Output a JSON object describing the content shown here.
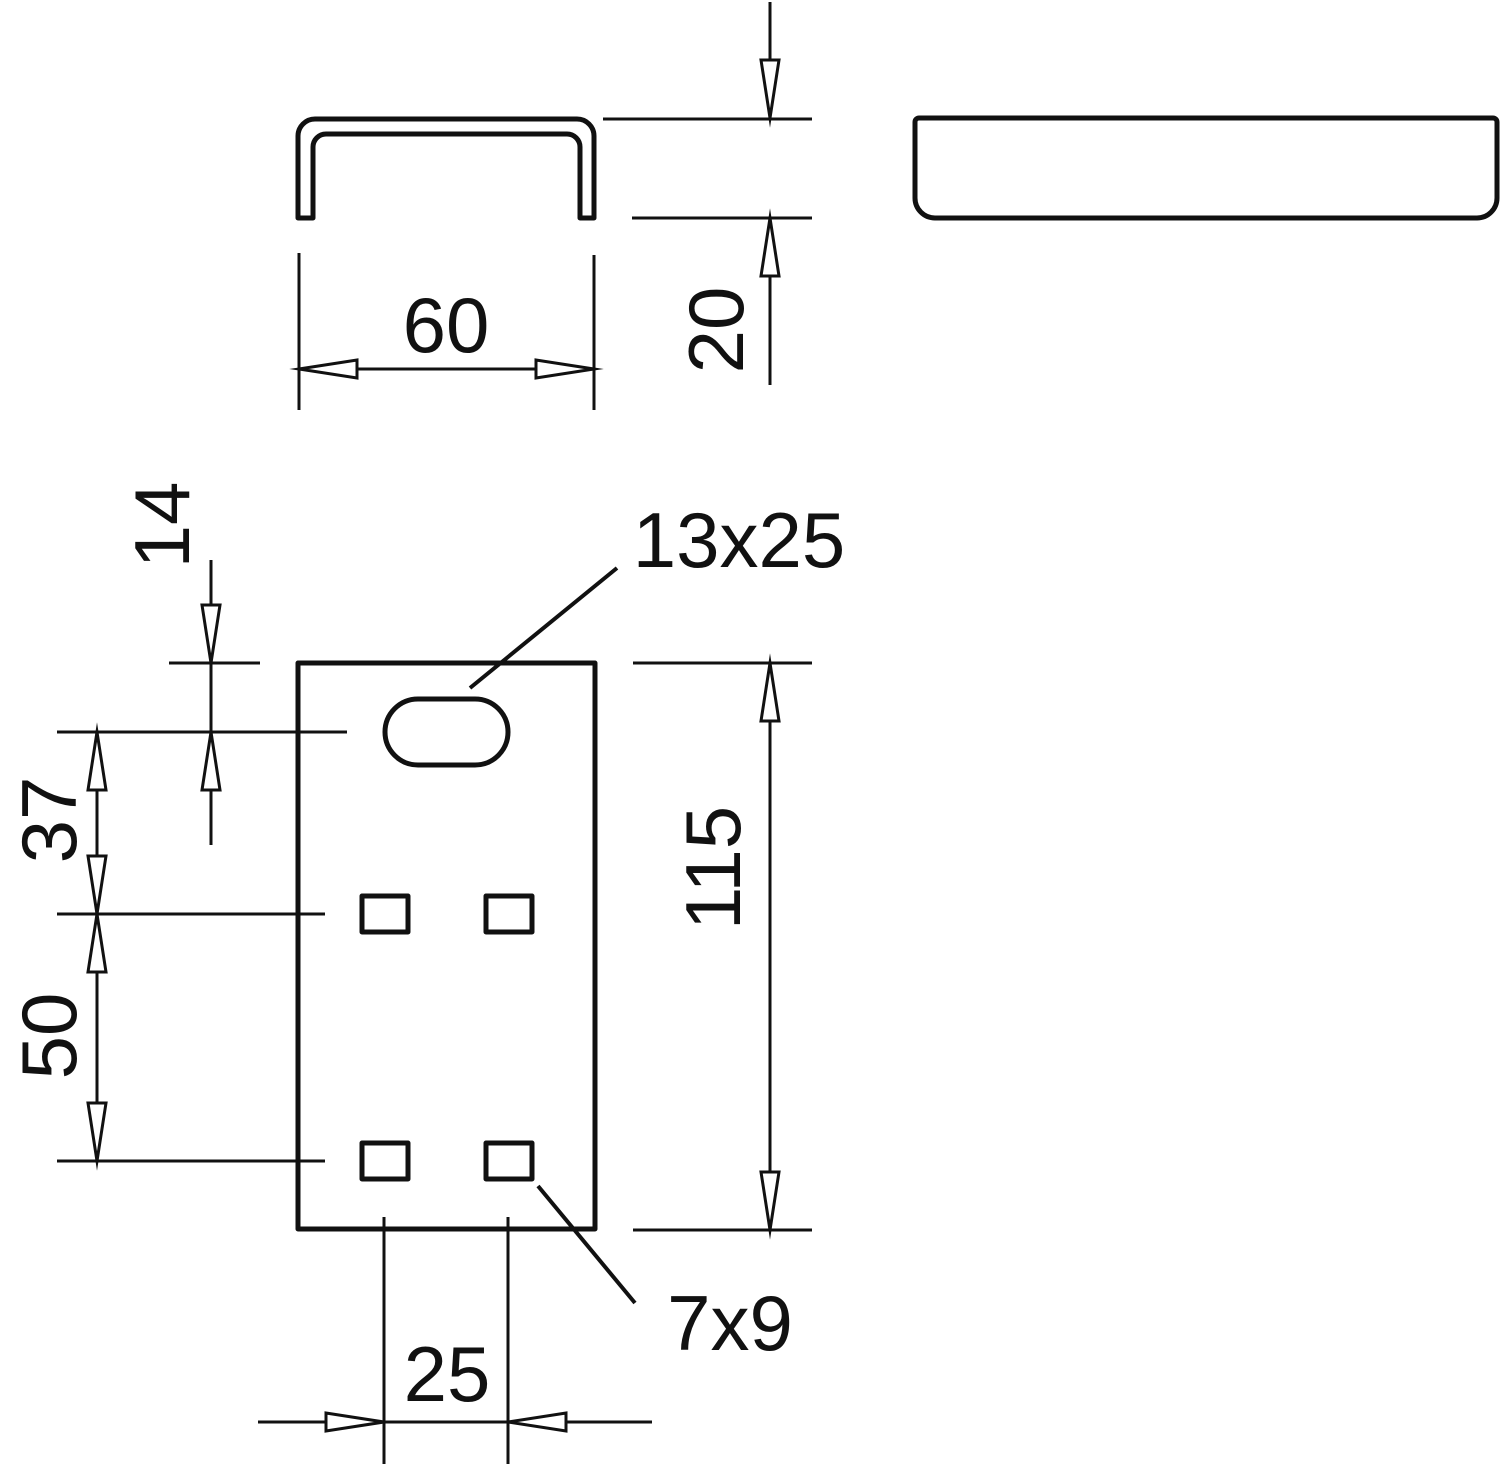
{
  "colors": {
    "line": "#111111",
    "background": "#ffffff"
  },
  "drawing": {
    "cross_section": {
      "width_label": "60",
      "height_label": "20"
    },
    "front_view": {
      "slot_size_label": "13x25",
      "hole_size_label": "7x9",
      "top_to_slot_label": "14",
      "slot_to_first_row_label": "37",
      "row_to_row_label": "50",
      "plate_height_label": "115",
      "hole_spacing_label": "25"
    }
  }
}
